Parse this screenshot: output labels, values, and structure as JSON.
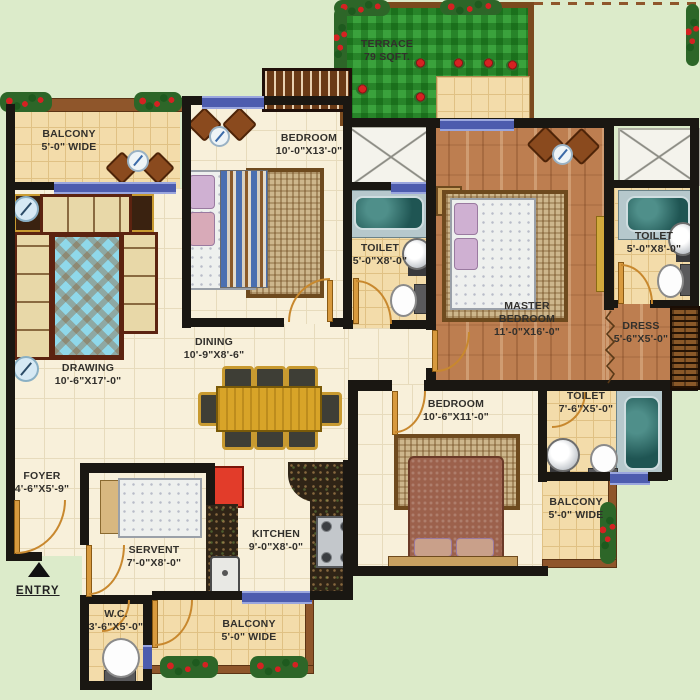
{
  "colors": {
    "background": "#dcebca",
    "wall": "#1a1712",
    "window": "#4d5cae",
    "floor_tile": "#f8f0da",
    "balcony_tile": "#f3dcaa",
    "wood_floor": "#bd7e50",
    "terrace_green": "#3aa23c",
    "flower_red": "#d42222"
  },
  "rooms": {
    "balcony_tl": {
      "name": "BALCONY",
      "dim": "5'-0\" WIDE"
    },
    "drawing": {
      "name": "DRAWING",
      "dim": "10'-6\"X17'-0\""
    },
    "bedroom_top": {
      "name": "BEDROOM",
      "dim": "10'-0\"X13'-0\""
    },
    "terrace": {
      "name": "TERRACE",
      "dim": "79 SQFT."
    },
    "toilet_left": {
      "name": "TOILET",
      "dim": "5'-0\"X8'-0\""
    },
    "master_bedroom": {
      "name": "MASTER BEDROOM",
      "dim": "11'-0\"X16'-0\""
    },
    "toilet_right": {
      "name": "TOILET",
      "dim": "5'-0\"X8'-0\""
    },
    "dress": {
      "name": "DRESS",
      "dim": "5'-6\"X5'-0\""
    },
    "dining": {
      "name": "DINING",
      "dim": "10'-9\"X8'-6\""
    },
    "bedroom_bottom": {
      "name": "BEDROOM",
      "dim": "10'-6\"X11'-0\""
    },
    "toilet_bottom": {
      "name": "TOILET",
      "dim": "7'-6\"X5'-0\""
    },
    "balcony_br": {
      "name": "BALCONY",
      "dim": "5'-0\" WIDE"
    },
    "foyer": {
      "name": "FOYER",
      "dim": "4'-6\"X5'-9\""
    },
    "servent": {
      "name": "SERVENT",
      "dim": "7'-0\"X8'-0\""
    },
    "kitchen": {
      "name": "KITCHEN",
      "dim": "9'-0\"X8'-0\""
    },
    "wc": {
      "name": "W.C.",
      "dim": "3'-6\"X5'-0\""
    },
    "balcony_bottom": {
      "name": "BALCONY",
      "dim": "5'-0\" WIDE"
    }
  },
  "entry_label": "ENTRY"
}
